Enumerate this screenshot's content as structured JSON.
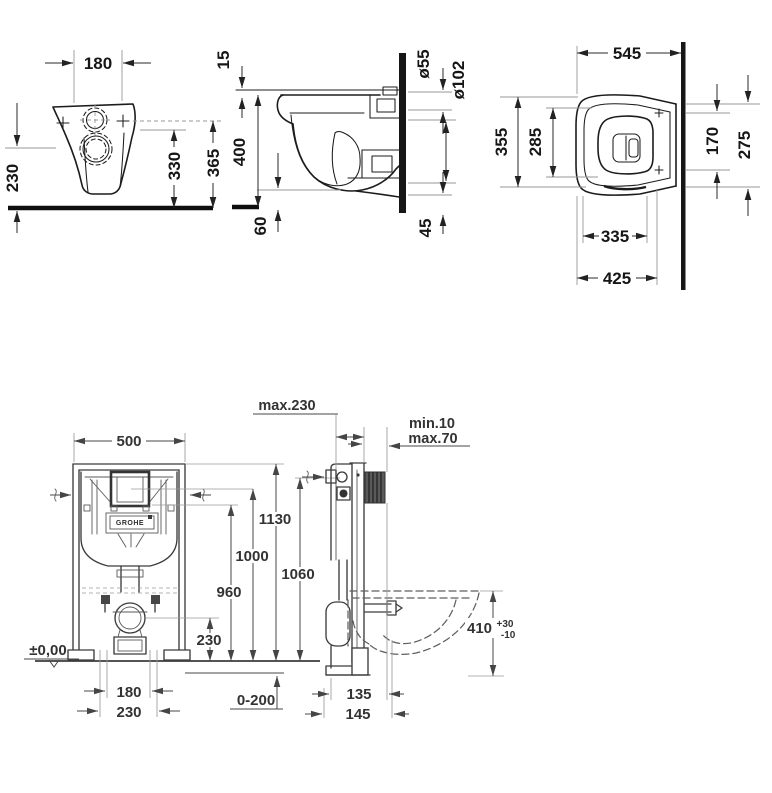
{
  "drawing": {
    "type": "technical dimension drawing",
    "subject": "wall-hung toilet with concealed installation frame",
    "front_view": {
      "hole_spacing": "180",
      "outlet_height": "230",
      "h330": "330",
      "h365": "365"
    },
    "side_view": {
      "rim_offset": "15",
      "depth": "400",
      "d60": "60",
      "flush_dia": "ø55",
      "outlet_dia": "ø102",
      "d45": "45"
    },
    "plan_view": {
      "depth": "545",
      "width": "355",
      "inner_width": "285",
      "d170": "170",
      "d275": "275",
      "d335": "335",
      "d425": "425"
    },
    "frame_front_view": {
      "width": "500",
      "h1130": "1130",
      "h1000": "1000",
      "h960": "960",
      "outlet_height": "230",
      "datum": "±0,00",
      "b180": "180",
      "b230": "230",
      "floor_range": "0-200",
      "brand": "GROHE"
    },
    "frame_side_view": {
      "wall_clearance": "max.230",
      "cover_min": "min.10",
      "cover_max": "max.70",
      "h1060": "1060",
      "bowl_height": "410",
      "tol_plus": "+30",
      "tol_minus": "-10",
      "d135": "135",
      "d145": "145"
    }
  }
}
